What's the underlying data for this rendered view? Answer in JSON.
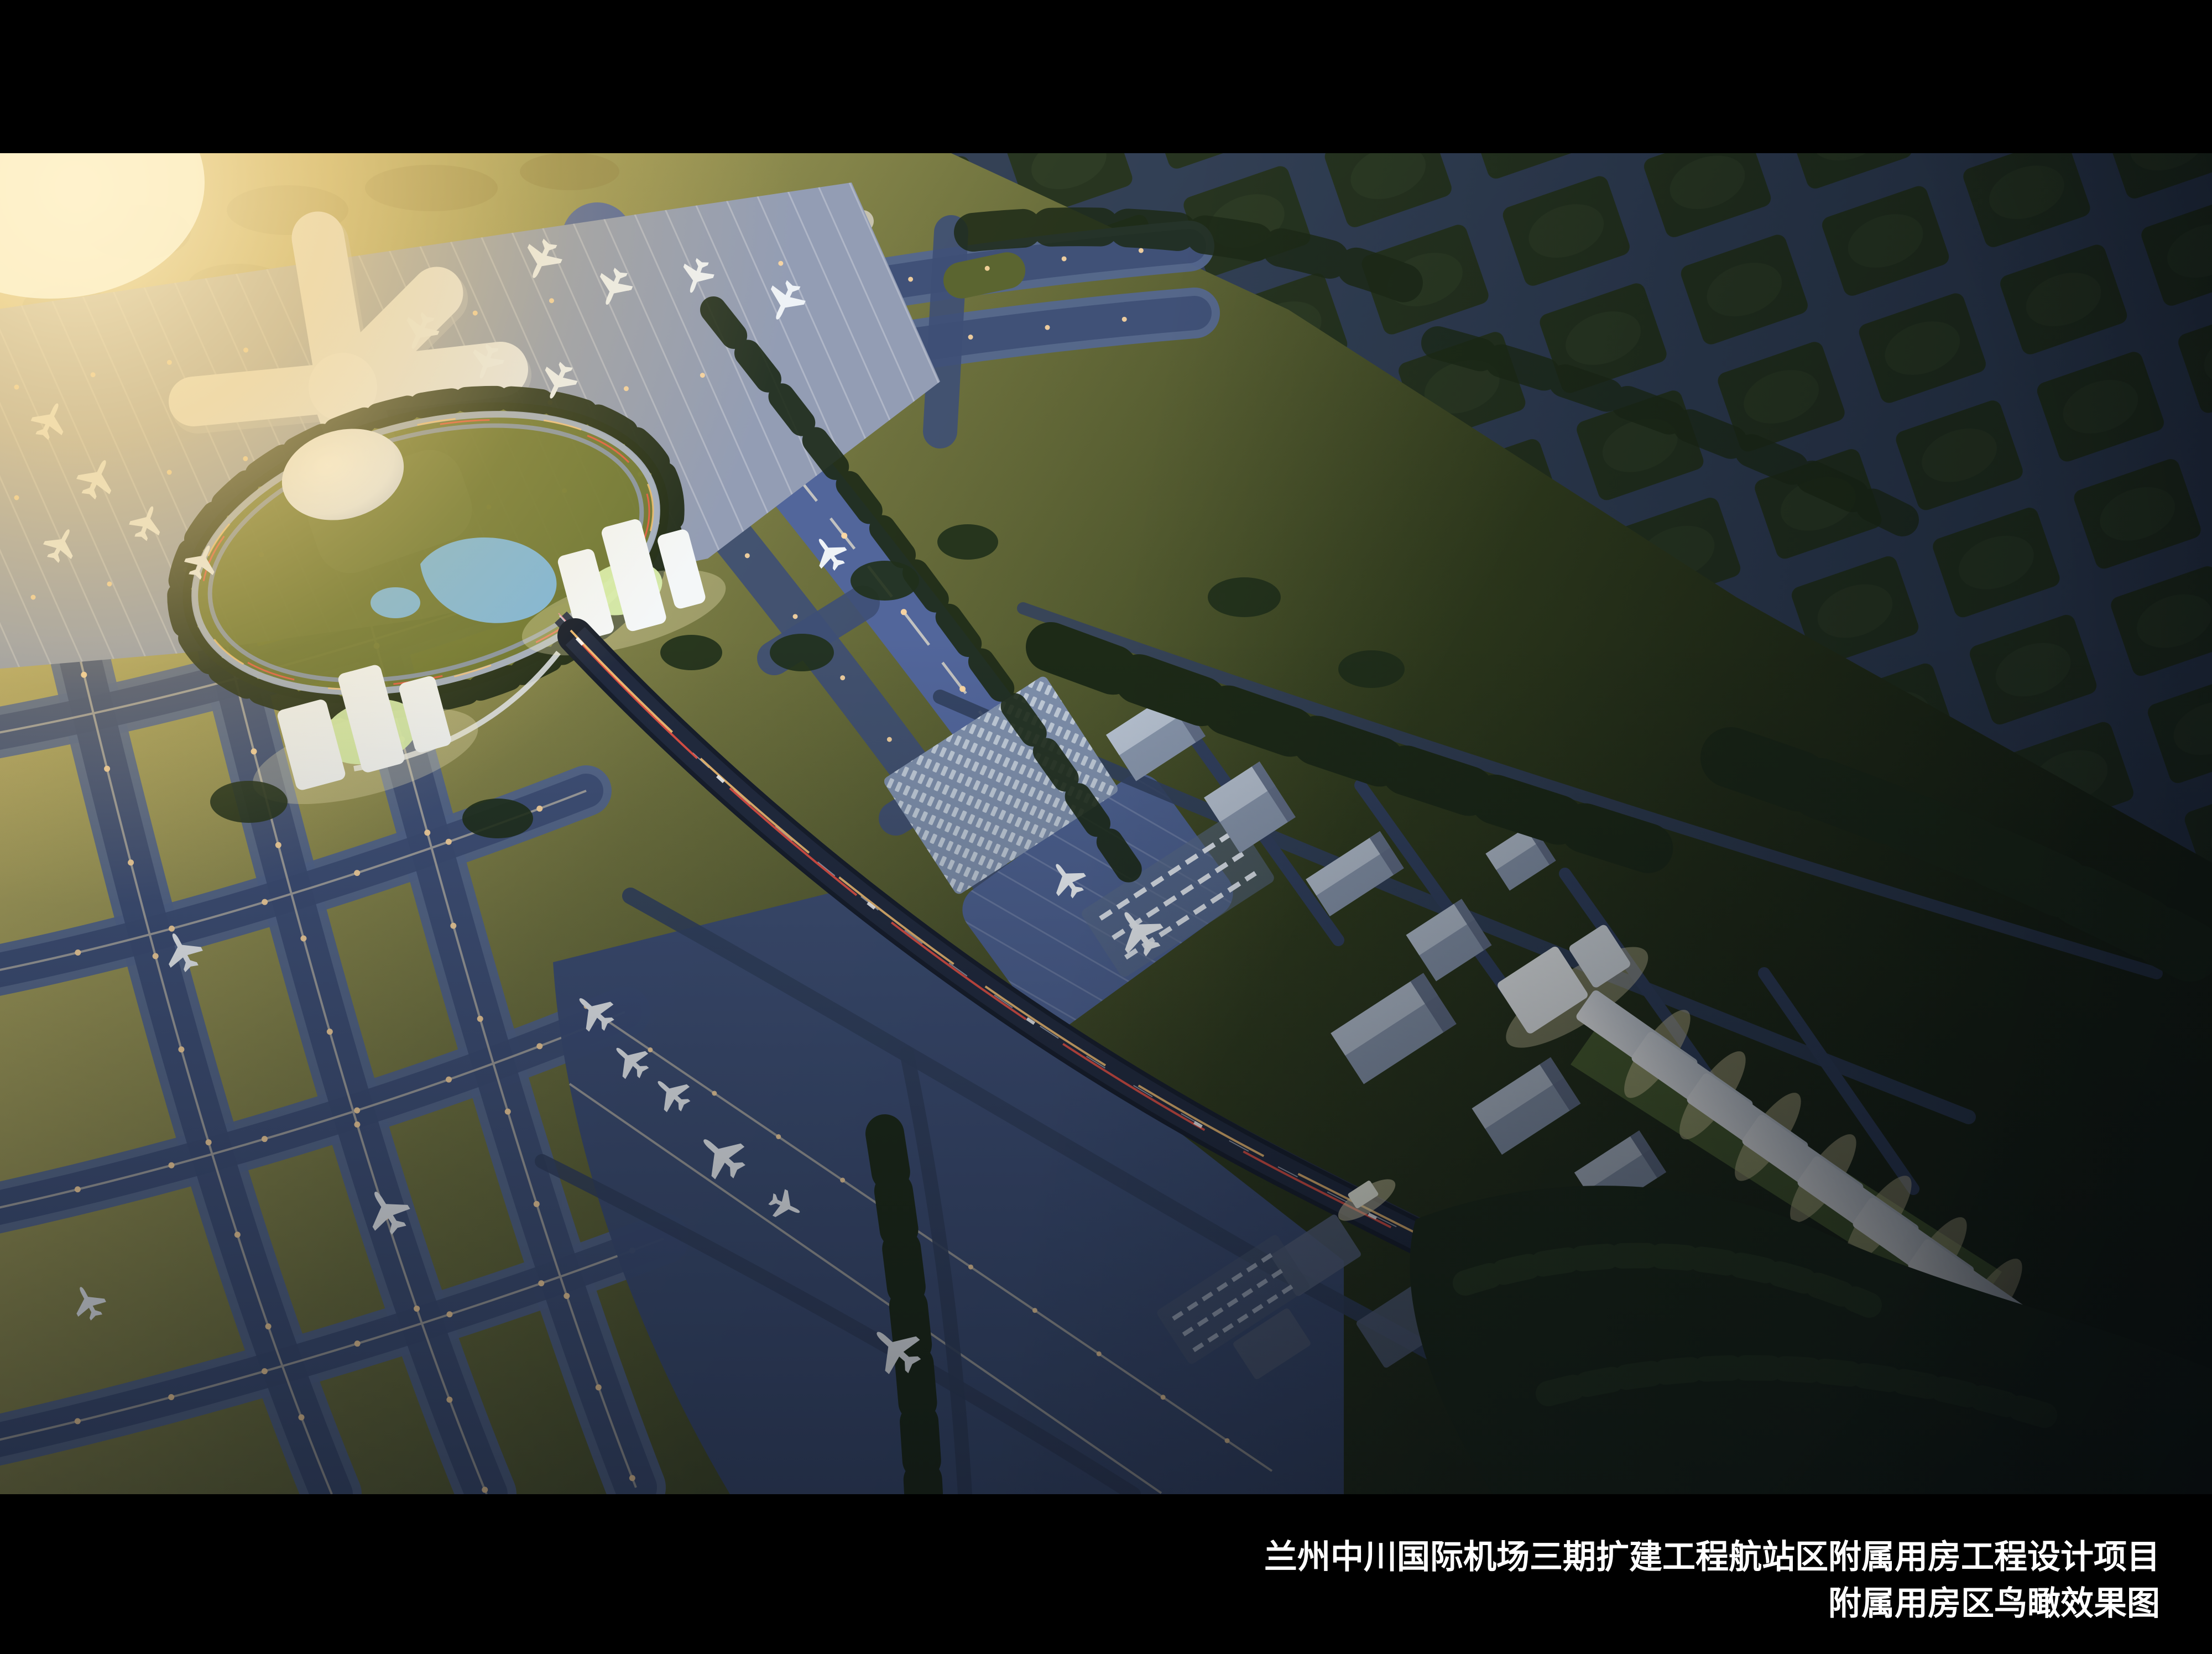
{
  "caption": {
    "line1": "兰州中川国际机场三期扩建工程航站区附属用房工程设计项目",
    "line2": "附属用房区鸟瞰效果图"
  },
  "colors": {
    "letterbox": "#000000",
    "caption_text": "#ffffff",
    "sun_glow": "#ffeec2",
    "terrain_sunlit": "#b3a257",
    "terrain_green": "#4f5a2a",
    "terrain_dark": "#1a2413",
    "forest": "#1d2a17",
    "taxiway": "#55688f",
    "taxiway_inner": "#3e4f76",
    "taxiway_line": "#f0e2c0",
    "light_amber": "#ffd9a2",
    "apron": "#939db4",
    "apron_remote": "#3d4e77",
    "terminal_white": "#e9ebef",
    "dome_white": "#f4f5f8",
    "lake_blue": "#7fb7da",
    "lawn_olive": "#6d762f",
    "lawn_glow": "#d9efad",
    "building_grey": "#8b99af",
    "building_lit": "#f4f7f8",
    "highway_deck": "#171e2c",
    "highway_inner": "#222b3f",
    "trail_red": "#ff5747",
    "trail_amber": "#ffc877",
    "road_blue": "#32415f",
    "grid_block": "#22301e",
    "grid_road": "#2e3c57",
    "plane_white": "#eef2f6"
  }
}
